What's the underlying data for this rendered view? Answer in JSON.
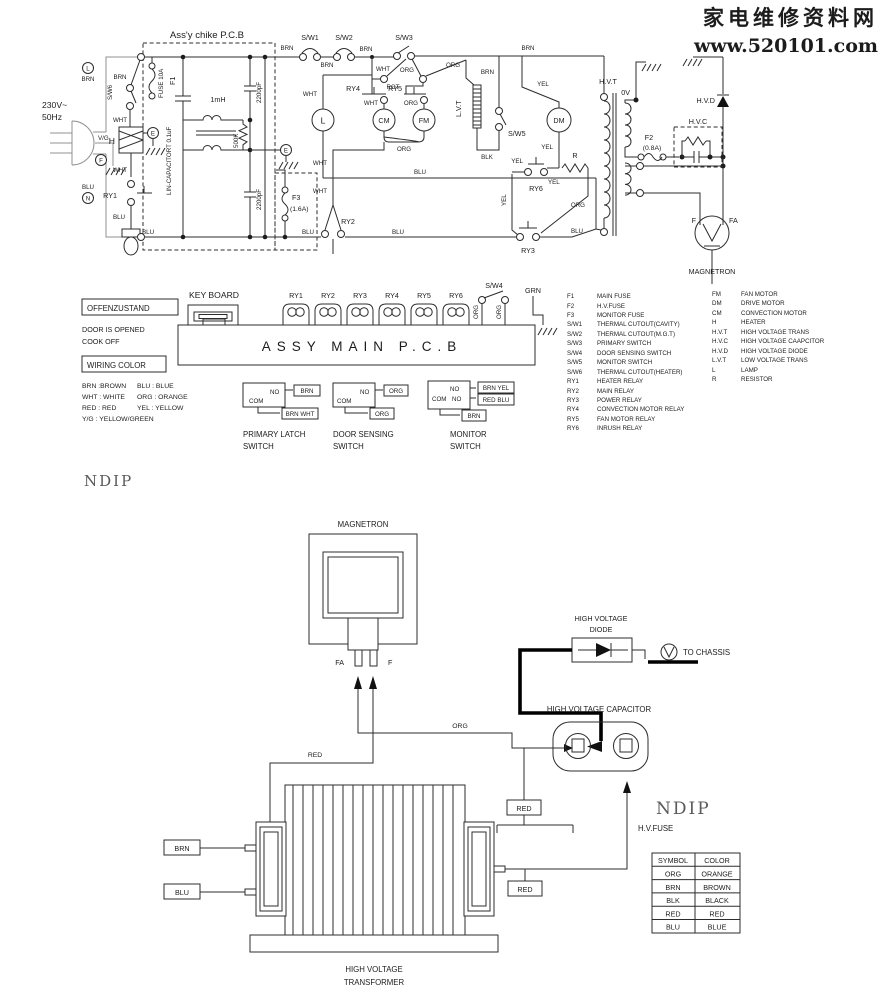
{
  "watermark": {
    "brand": "家电维修资料网",
    "url": "www.520101.com"
  },
  "wire": {
    "brn": "BRN",
    "wht": "WHT",
    "blu": "BLU",
    "org": "ORG",
    "yel": "YEL",
    "blk": "BLK",
    "grn": "GRN",
    "red": "RED",
    "rot": "ROT",
    "vg": "V/G"
  },
  "terminals": {
    "l": "L",
    "n": "N",
    "f": "F",
    "e": "E",
    "zero_v": "0V",
    "f_mag": "F",
    "fa_mag": "FA"
  },
  "upper": {
    "pcb_title": "Ass'y chike P.C.B",
    "voltage": "230V~",
    "freq": "50Hz",
    "fuse10a": "FUSE 10A",
    "f1": "F1",
    "lin_cap": "LIN-CAPACITORT 0.1uF",
    "inductor": "1mH",
    "res500k": "500K",
    "cap2200": "2200pF",
    "f3": "F3",
    "f3_rating": "(1.6A)",
    "f2": "F2",
    "f2_rating": "(0.8A)",
    "sw1": "S/W1",
    "sw2": "S/W2",
    "sw3": "S/W3",
    "sw4": "S/W4",
    "sw5": "S/W5",
    "sw6": "S/W6",
    "ry1": "RY1",
    "ry2": "RY2",
    "ry3": "RY3",
    "ry4": "RY4",
    "ry5": "RY5",
    "ry6": "RY6",
    "heater": "H",
    "lamp": "L",
    "cm": "CM",
    "fm": "FM",
    "dm": "DM",
    "resistor": "R",
    "lvt": "L.V.T",
    "hvt": "H.V.T",
    "hvc": "H.V.C",
    "hvd": "H.V.D",
    "magnetron": "MAGNETRON"
  },
  "middle": {
    "offen_title": "OFFENZUSTAND",
    "offen1": "DOOR IS OPENED",
    "offen2": "COOK OFF",
    "wiring_title": "WIRING COLOR",
    "wc1": [
      "BRN :BROWN",
      "WHT : WHITE",
      "RED : RED",
      "Y/G : YELLOW/GREEN"
    ],
    "wc2": [
      "BLU : BLUE",
      "ORG : ORANGE",
      "YEL : YELLOW"
    ],
    "keyboard": "KEY BOARD",
    "main_pcb": "ASSY MAIN P.C.B",
    "com": "COM",
    "no": "NO",
    "legend1": [
      [
        "F1",
        "MAIN FUSE"
      ],
      [
        "F2",
        "H.V.FUSE"
      ],
      [
        "F3",
        "MONITOR FUSE"
      ],
      [
        "S/W1",
        "THERMAL CUTOUT(CAVITY)"
      ],
      [
        "S/W2",
        "THERMAL CUTOUT(M.G.T)"
      ],
      [
        "S/W3",
        "PRIMARY SWITCH"
      ],
      [
        "S/W4",
        "DOOR SENSING SWITCH"
      ],
      [
        "S/W5",
        "MONITOR SWITCH"
      ],
      [
        "S/W6",
        "THERMAL CUTOUT(HEATER)"
      ],
      [
        "RY1",
        "HEATER RELAY"
      ],
      [
        "RY2",
        "MAIN RELAY"
      ],
      [
        "RY3",
        "POWER RELAY"
      ],
      [
        "RY4",
        "CONVECTION MOTOR RELAY"
      ],
      [
        "RY5",
        "FAN MOTOR RELAY"
      ],
      [
        "RY6",
        "INRUSH RELAY"
      ]
    ],
    "legend2": [
      [
        "FM",
        "FAN MOTOR"
      ],
      [
        "DM",
        "DRIVE MOTOR"
      ],
      [
        "CM",
        "CONVECTION MOTOR"
      ],
      [
        "H",
        "HEATER"
      ],
      [
        "H.V.T",
        "HIGH VOLTAGE TRANS"
      ],
      [
        "H.V.C",
        "HIGH VOLTAGE CAAPCITOR"
      ],
      [
        "H.V.D",
        "HIGH VOLTAGE DIODE"
      ],
      [
        "L.V.T",
        "LOW VOLTAGE TRANS"
      ],
      [
        "L",
        "LAMP"
      ],
      [
        "R",
        "RESISTOR"
      ]
    ],
    "sw_primary": {
      "t1": "PRIMARY LATCH",
      "t2": "SWITCH",
      "no_wire": "BRN",
      "com_wire": "BRN WHT"
    },
    "sw_door": {
      "t1": "DOOR SENSING",
      "t2": "SWITCH",
      "no_wire": "ORG",
      "com_wire": "ORG"
    },
    "sw_monitor": {
      "t1": "MONITOR",
      "t2": "SWITCH",
      "no1_wire": "BRN YEL",
      "no2_wire": "RED BLU",
      "com_wire": "BRN"
    },
    "ndip": "NDIP"
  },
  "bottom": {
    "magnetron": "MAGNETRON",
    "fa": "FA",
    "f": "F",
    "diode_t1": "HIGH VOLTAGE",
    "diode_t2": "DIODE",
    "to_chassis": "TO CHASSIS",
    "cap_title": "HIGH VOLTAGE CAPACITOR",
    "hv_fuse": "H.V.FUSE",
    "ndip": "NDIP",
    "tr_t1": "HIGH VOLTAGE",
    "tr_t2": "TRANSFORMER",
    "table": {
      "h1": "SYMBOL",
      "h2": "COLOR",
      "rows": [
        [
          "ORG",
          "ORANGE"
        ],
        [
          "BRN",
          "BROWN"
        ],
        [
          "BLK",
          "BLACK"
        ],
        [
          "RED",
          "RED"
        ],
        [
          "BLU",
          "BLUE"
        ]
      ]
    }
  }
}
